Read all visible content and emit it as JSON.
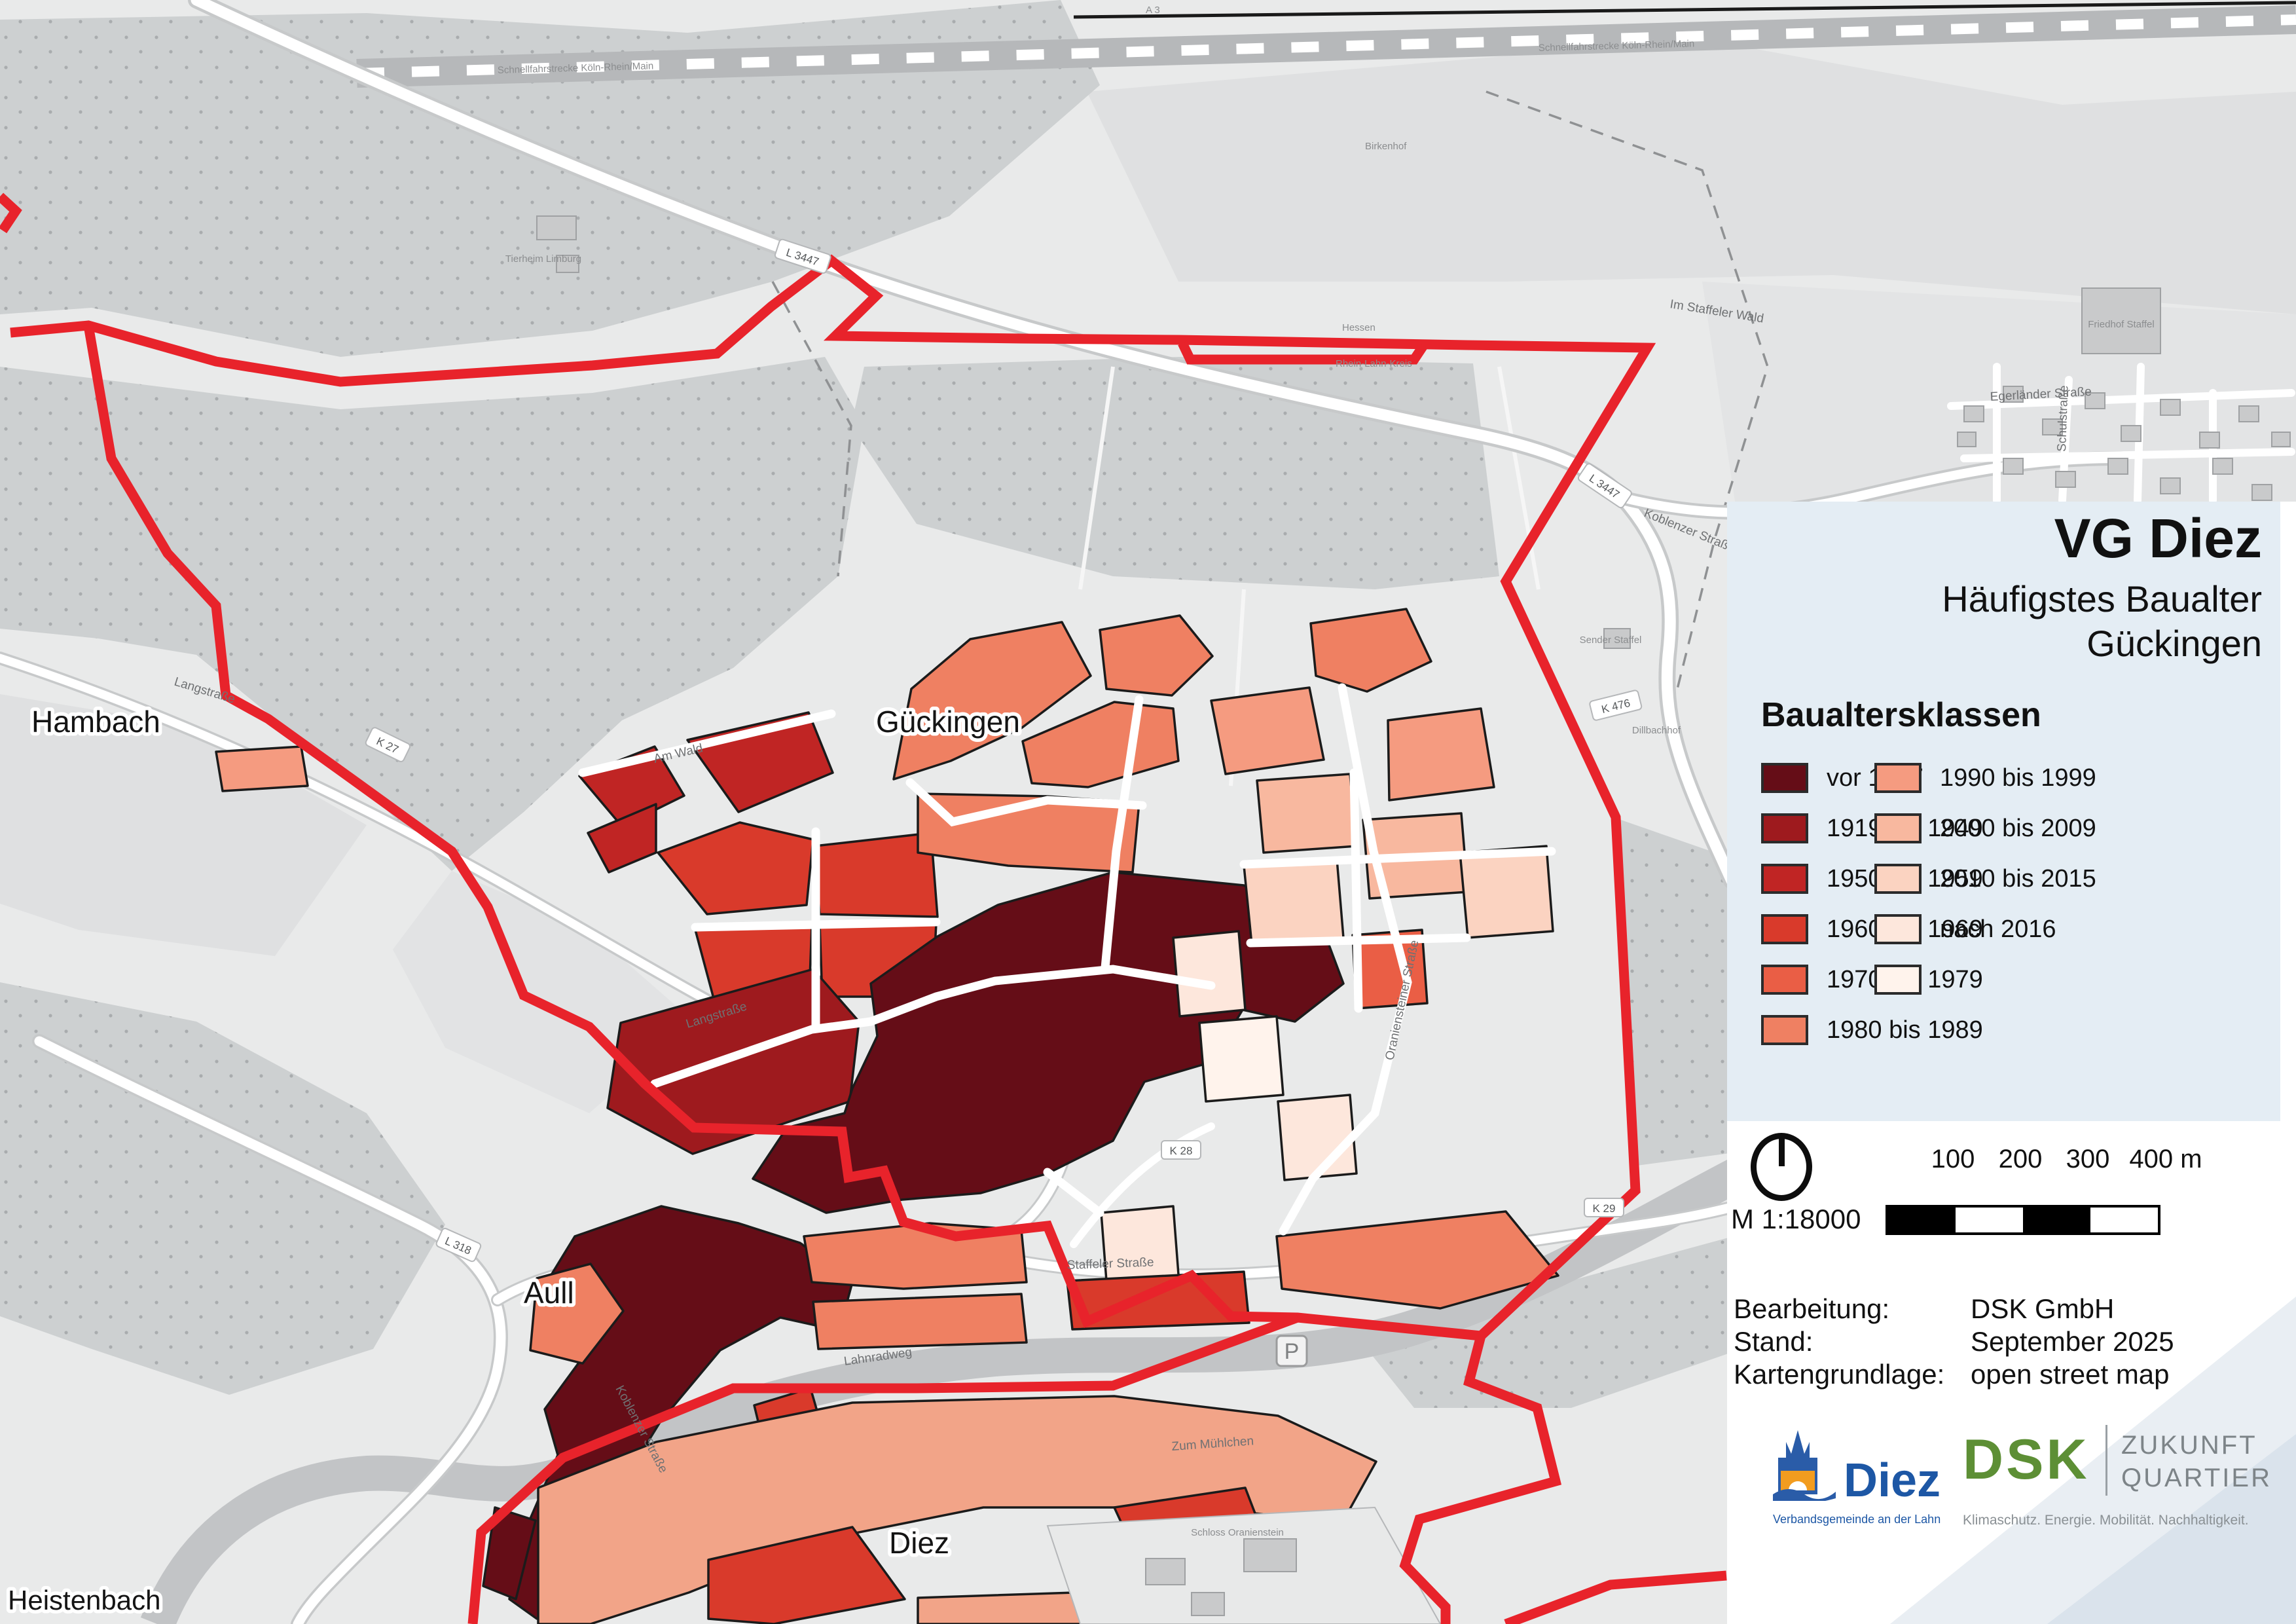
{
  "map": {
    "boundary_color": "#e8232b",
    "place_labels": [
      {
        "text": "Hambach"
      },
      {
        "text": "Gückingen"
      },
      {
        "text": "Aull"
      },
      {
        "text": "Diez"
      },
      {
        "text": "Heistenbach"
      }
    ],
    "route_refs": [
      {
        "text": "L 3447"
      },
      {
        "text": "L 3447"
      },
      {
        "text": "K 476"
      },
      {
        "text": "K 27"
      },
      {
        "text": "L 318"
      },
      {
        "text": "K 28"
      },
      {
        "text": "K 29"
      }
    ],
    "street_labels": [
      {
        "text": "Langstraße"
      },
      {
        "text": "Koblenzer Straße"
      },
      {
        "text": "Staffeler Straße"
      },
      {
        "text": "Lahnradweg"
      },
      {
        "text": "Oraniensteiner Straße"
      },
      {
        "text": "Zum Mühlchen"
      },
      {
        "text": "Am Wald"
      },
      {
        "text": "Im Staffeler Wald"
      },
      {
        "text": "Schulstraße"
      },
      {
        "text": "Egerländer Straße"
      }
    ],
    "poi_labels": [
      {
        "text": "Sender Staffel"
      },
      {
        "text": "Tierheim Limburg"
      },
      {
        "text": "Birkenhof"
      },
      {
        "text": "Friedhof Staffel"
      },
      {
        "text": "Grundschule Staffel"
      },
      {
        "text": "Dillbachhof"
      },
      {
        "text": "Schloss Oranienstein"
      },
      {
        "text": "Schnellfahrstrecke Köln-Rhein/Main"
      },
      {
        "text": "A 3"
      },
      {
        "text": "Hessen"
      },
      {
        "text": "Rhein-Lahn-Kreis"
      },
      {
        "text": "P"
      }
    ]
  },
  "panel": {
    "bg": "#e4edf4",
    "title": "VG Diez",
    "subtitle1": "Häufigstes Baualter",
    "subtitle2": "Gückingen",
    "legend_title": "Baualtersklassen",
    "legend_left": [
      {
        "label": "vor 1917",
        "color": "#650d17"
      },
      {
        "label": "1919 bis 1949",
        "color": "#9e1a1e"
      },
      {
        "label": "1950 bis 1959",
        "color": "#c02524"
      },
      {
        "label": "1960 bis 1969",
        "color": "#d93a2b"
      },
      {
        "label": "1970 bis 1979",
        "color": "#ea5e45"
      },
      {
        "label": "1980 bis 1989",
        "color": "#ef8062"
      }
    ],
    "legend_right": [
      {
        "label": "1990 bis 1999",
        "color": "#f59b80"
      },
      {
        "label": "2000 bis 2009",
        "color": "#f8b89f"
      },
      {
        "label": "2010 bis 2015",
        "color": "#fbd3c1"
      },
      {
        "label": "nach 2016",
        "color": "#fde7dc"
      },
      {
        "label": "",
        "color": "#fff3ec"
      }
    ]
  },
  "info": {
    "scale_label": "M 1:18000",
    "ticks": [
      "100",
      "200",
      "300",
      "400 m"
    ],
    "rows": [
      {
        "k": "Bearbeitung:",
        "v": "DSK GmbH"
      },
      {
        "k": "Stand:",
        "v": "September 2025"
      },
      {
        "k": "Kartengrundlage:",
        "v": "open street map"
      }
    ]
  },
  "logos": {
    "diez": {
      "name": "Diez",
      "tagline": "Verbandsgemeinde an der Lahn"
    },
    "dsk": {
      "name": "DSK",
      "line1": "ZUKUNFT",
      "line2": "QUARTIER",
      "tagline": "Klimaschutz. Energie. Mobilität. Nachhaltigkeit."
    }
  }
}
